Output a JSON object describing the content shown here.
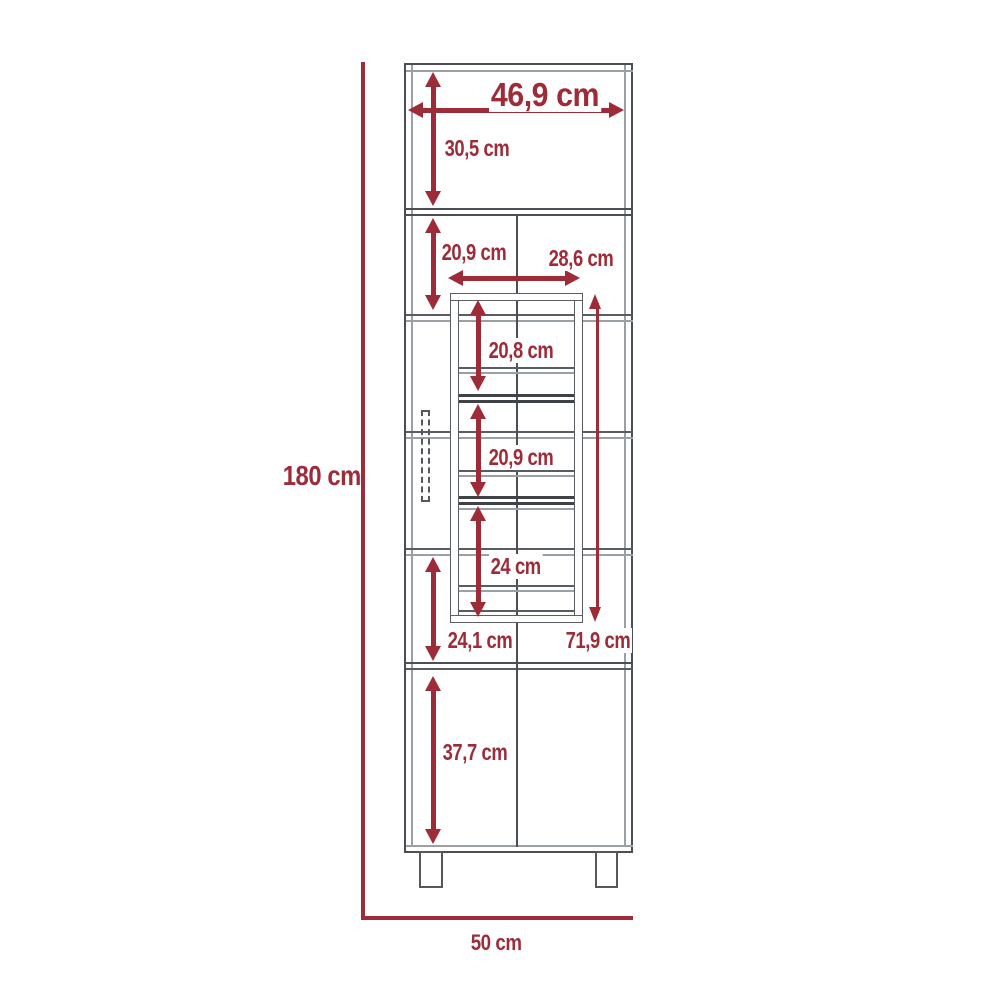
{
  "diagram": {
    "type": "furniture-dimension-drawing",
    "subject": "tall cabinet with internal storage rack, front view",
    "unit": "cm",
    "colors": {
      "dimension_accent": "#9d2b38",
      "outline_dark": "#4b4f55",
      "outline_mid": "#595d63",
      "outline_light": "#9ba0a5",
      "background": "#ffffff"
    },
    "dimensions": {
      "top_inner_width": "46,9 cm",
      "top_section_height": "30,5 cm",
      "second_section_height": "20,9 cm",
      "rack_width": "28,6 cm",
      "rack_upper_gap": "20,8 cm",
      "rack_middle_gap": "20,9 cm",
      "rack_lower_gap": "24 cm",
      "rack_total_height": "71,9 cm",
      "lower_section_height": "24,1 cm",
      "door_section_height": "37,7 cm",
      "overall_height": "180 cm",
      "overall_width": "50 cm"
    }
  }
}
